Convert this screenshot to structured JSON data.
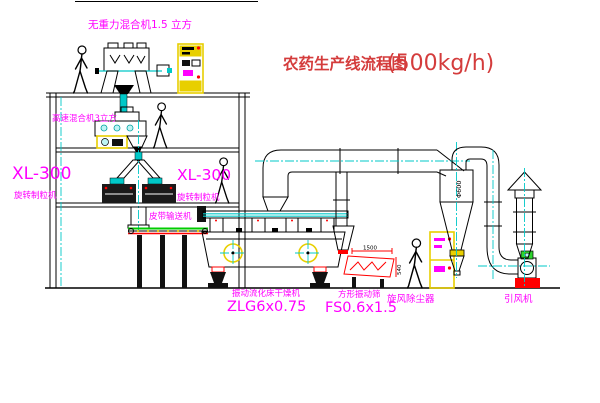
{
  "diagram": {
    "title": "农药生产线流程图",
    "capacity": "(500kg/h)"
  },
  "equipment_labels": {
    "gravity_free_mixer": "无重力混合机1.5 立方",
    "high_speed_mixer": "高速混合机3立方",
    "granulator_model_left": "XL-300",
    "granulator_name_left": "旋转制粒机",
    "granulator_model_right": "XL-300",
    "granulator_name_right": "旋转制粒机",
    "belt_conveyor": "皮带输送机",
    "fluid_bed_dryer_name": "振动流化床干燥机",
    "fluid_bed_dryer_model": "ZLG6x0.75",
    "square_sieve_name": "方形振动筛",
    "square_sieve_model": "FS0.6x1.5",
    "cyclone_dust_collector": "旋风除尘器",
    "induced_draft_fan": "引风机"
  },
  "dimensions": {
    "cyclone_diameter": "Φ600",
    "sieve_length": "1500",
    "sieve_height": "540"
  },
  "colors": {
    "label_magenta": "#ff00ff",
    "title_red": "#d43c3c",
    "line_black": "#000000",
    "centerline_cyan": "#00c8c8",
    "cabinet_yellow": "#e8cf00",
    "conveyor_green": "#00cc00",
    "accent_red": "#ff0000"
  }
}
